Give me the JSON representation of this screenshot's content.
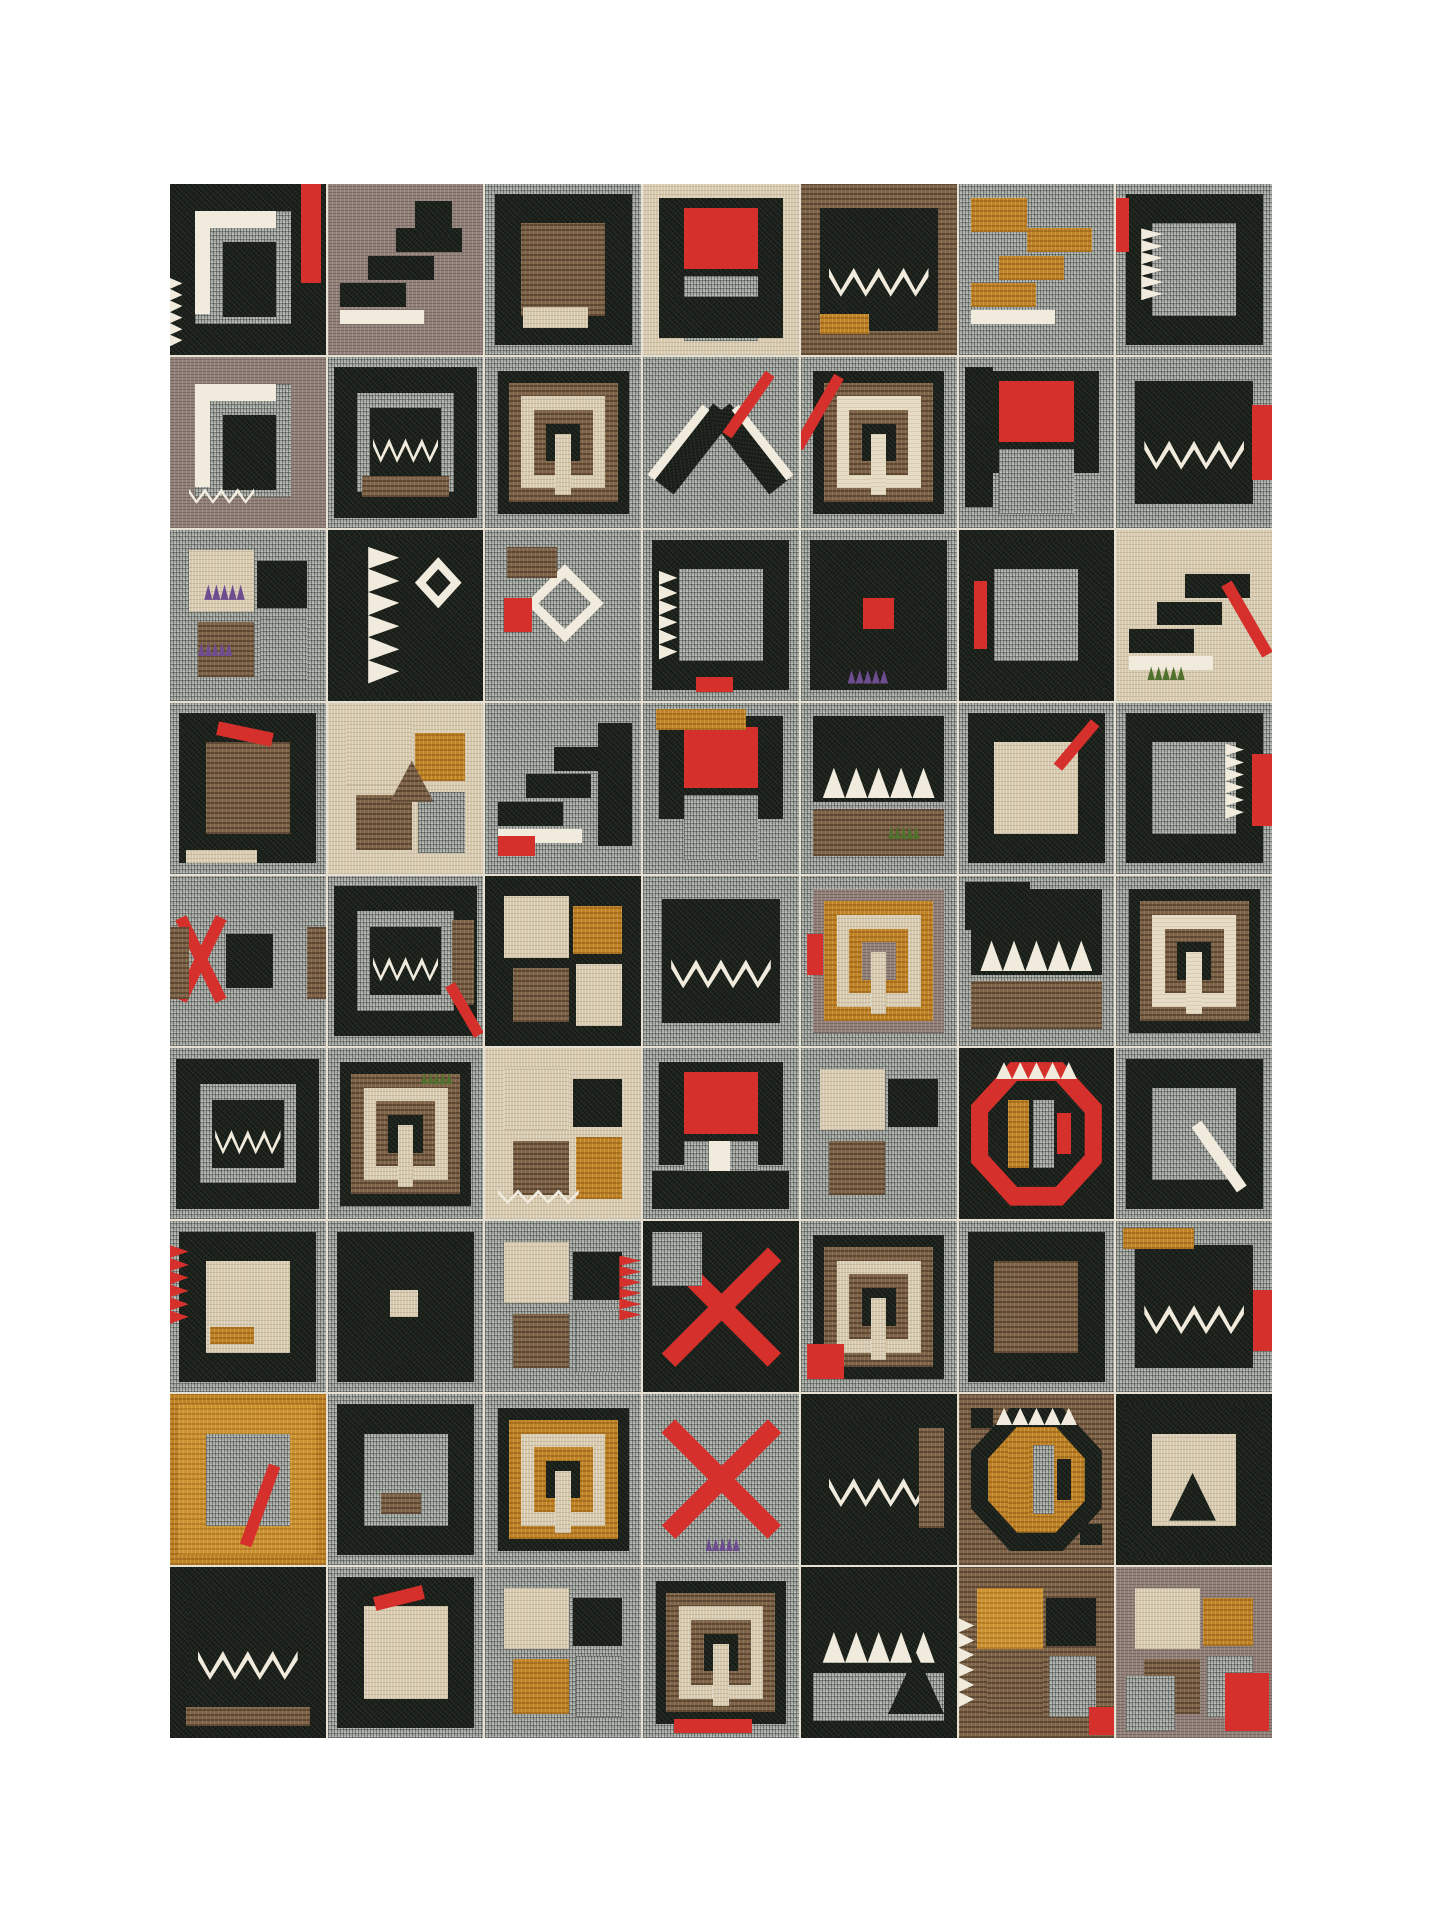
{
  "page": {
    "background": "#ffffff"
  },
  "artwork": {
    "kind": "fabric-collage-grid",
    "left": 170,
    "top": 184,
    "width": 1102,
    "height": 1554,
    "cols": 7,
    "rows": 9,
    "seam_color": "#e7e1d3"
  },
  "palette": {
    "gray": "#a4a8a2",
    "black": "#1d231c",
    "brown": "#7d6348",
    "tan": "#d6c9ae",
    "mauve": "#93827b",
    "ochre": "#bf8226",
    "cream": "#e7ddc6",
    "gold": "#cd9231",
    "red": "#d6302c",
    "white": "#f1ebdd",
    "purple": "#6d4d90",
    "green": "#50702e"
  },
  "textured": [
    "gray",
    "black",
    "brown",
    "tan",
    "mauve",
    "ochre",
    "cream",
    "gold"
  ],
  "motifs": {
    "bars": [
      [
        "r",
        "gray",
        16,
        16,
        62,
        66
      ],
      [
        "r",
        "white",
        16,
        16,
        10,
        60
      ],
      [
        "r",
        "white",
        16,
        16,
        52,
        10
      ],
      [
        "r",
        "black",
        34,
        34,
        34,
        44
      ]
    ],
    "frame": [
      [
        "r",
        "black",
        6,
        6,
        88,
        88
      ],
      [
        "r",
        "gray",
        23,
        23,
        54,
        54
      ]
    ],
    "crown": [
      [
        "r",
        "black",
        12,
        14,
        76,
        72
      ],
      [
        "zz",
        "white",
        18,
        40,
        64,
        26
      ]
    ],
    "crownframe": [
      [
        "r",
        "black",
        4,
        6,
        92,
        88
      ],
      [
        "r",
        "gray",
        19,
        21,
        62,
        58
      ],
      [
        "r",
        "black",
        27,
        30,
        46,
        40
      ],
      [
        "zz",
        "white",
        29,
        40,
        42,
        22
      ]
    ],
    "teeth": [
      [
        "r",
        "black",
        8,
        8,
        84,
        50
      ],
      [
        "tu",
        "white",
        14,
        38,
        72,
        18
      ],
      [
        "r",
        "brown",
        8,
        62,
        84,
        28
      ]
    ],
    "keys": [
      [
        "r",
        "black",
        8,
        8,
        84,
        84
      ],
      [
        "r",
        "brown",
        15,
        15,
        70,
        70
      ],
      [
        "r",
        "tan",
        23,
        23,
        54,
        54
      ],
      [
        "r",
        "brown",
        31,
        31,
        38,
        38
      ],
      [
        "r",
        "black",
        39,
        39,
        22,
        22
      ],
      [
        "r",
        "tan",
        45,
        45,
        10,
        36
      ]
    ],
    "redblock": [
      [
        "r",
        "black",
        10,
        8,
        80,
        60
      ],
      [
        "r",
        "red",
        26,
        14,
        48,
        36
      ],
      [
        "r",
        "gray",
        26,
        54,
        48,
        38
      ]
    ],
    "cross": [
      [
        "bar",
        "red",
        44,
        6,
        12,
        88,
        45
      ],
      [
        "bar",
        "red",
        44,
        6,
        12,
        88,
        -45
      ]
    ],
    "steps": [
      [
        "r",
        "black",
        8,
        58,
        42,
        14
      ],
      [
        "r",
        "black",
        26,
        42,
        42,
        14
      ],
      [
        "r",
        "black",
        44,
        26,
        42,
        14
      ],
      [
        "r",
        "white",
        8,
        74,
        54,
        8
      ]
    ],
    "blocks": [
      [
        "r",
        "tan",
        12,
        12,
        42,
        36
      ],
      [
        "r",
        "black",
        56,
        18,
        32,
        28
      ],
      [
        "r",
        "brown",
        18,
        54,
        36,
        32
      ],
      [
        "r",
        "gray",
        58,
        52,
        30,
        36
      ]
    ],
    "chevron": [
      [
        "bar",
        "black",
        24,
        26,
        16,
        56,
        38
      ],
      [
        "bar",
        "black",
        60,
        26,
        16,
        56,
        -38
      ],
      [
        "bar",
        "white",
        20,
        24,
        6,
        52,
        38
      ],
      [
        "bar",
        "white",
        74,
        24,
        6,
        52,
        -38
      ]
    ],
    "zigzagcol": [
      [
        "r",
        "black",
        8,
        4,
        84,
        92
      ],
      [
        "tl",
        "white",
        26,
        10,
        20,
        80
      ],
      [
        "dia",
        "white",
        56,
        16,
        30,
        30
      ],
      [
        "dia",
        "black",
        63,
        23,
        16,
        16
      ]
    ],
    "hexring": [
      [
        "oct",
        "red",
        8,
        8,
        84,
        84
      ],
      [
        "oct",
        "black",
        19,
        19,
        62,
        62
      ],
      [
        "r",
        "ochre",
        32,
        30,
        13,
        40
      ],
      [
        "r",
        "gray",
        48,
        30,
        13,
        40
      ],
      [
        "r",
        "red",
        63,
        38,
        9,
        24
      ],
      [
        "tu",
        "white",
        24,
        8,
        52,
        10
      ]
    ],
    "diamond": [
      [
        "dia",
        "white",
        26,
        20,
        50,
        46
      ],
      [
        "dia",
        "gray",
        34,
        28,
        34,
        30
      ],
      [
        "r",
        "red",
        12,
        40,
        18,
        20
      ]
    ],
    "brackets": [
      [
        "bar",
        "red",
        16,
        22,
        8,
        54,
        26
      ],
      [
        "bar",
        "red",
        16,
        22,
        8,
        54,
        -26
      ],
      [
        "r",
        "black",
        36,
        34,
        30,
        32
      ]
    ],
    "tri": [
      [
        "tri",
        "black",
        24,
        32,
        52,
        44
      ]
    ]
  },
  "tiles": [
    {
      "b": "black",
      "m": "bars",
      "add": [
        [
          "r",
          "red",
          84,
          0,
          13,
          58
        ],
        [
          "tl",
          "white",
          0,
          55,
          8,
          40
        ]
      ]
    },
    {
      "b": "mauve",
      "m": "steps",
      "add": [
        [
          "r",
          "black",
          56,
          10,
          24,
          20
        ]
      ]
    },
    {
      "b": "gray",
      "m": "frame",
      "sw": {
        "gray": "brown"
      },
      "add": [
        [
          "r",
          "tan",
          24,
          72,
          42,
          12
        ]
      ]
    },
    {
      "b": "tan",
      "m": "redblock",
      "add": [
        [
          "r",
          "black",
          10,
          66,
          80,
          24
        ]
      ]
    },
    {
      "b": "brown",
      "m": "crown",
      "add": [
        [
          "r",
          "ochre",
          12,
          76,
          32,
          12
        ]
      ]
    },
    {
      "b": "gray",
      "m": "steps",
      "sw": {
        "black": "ochre"
      },
      "add": [
        [
          "r",
          "black",
          8,
          8,
          36,
          20
        ]
      ]
    },
    {
      "b": "gray",
      "m": "frame",
      "add": [
        [
          "tl",
          "white",
          16,
          26,
          14,
          42
        ],
        [
          "r",
          "red",
          0,
          8,
          8,
          32
        ]
      ]
    },
    {
      "b": "mauve",
      "m": "bars",
      "add": [
        [
          "zz",
          "white",
          12,
          72,
          42,
          14
        ]
      ]
    },
    {
      "b": "gray",
      "m": "crownframe",
      "add": [
        [
          "r",
          "brown",
          22,
          70,
          56,
          12
        ]
      ]
    },
    {
      "b": "gray",
      "m": "keys"
    },
    {
      "b": "gray",
      "m": "chevron",
      "add": [
        [
          "bar",
          "red",
          64,
          6,
          7,
          44,
          35
        ]
      ]
    },
    {
      "b": "gray",
      "m": "keys",
      "sw": {
        "tan": "cream"
      },
      "add": [
        [
          "bar",
          "red",
          8,
          8,
          7,
          48,
          30
        ]
      ]
    },
    {
      "b": "gray",
      "m": "redblock",
      "add": [
        [
          "r",
          "black",
          4,
          6,
          18,
          82
        ]
      ]
    },
    {
      "b": "gray",
      "m": "crown",
      "add": [
        [
          "r",
          "red",
          87,
          28,
          13,
          44
        ]
      ]
    },
    {
      "b": "gray",
      "m": "blocks",
      "add": [
        [
          "tu",
          "purple",
          22,
          32,
          26,
          9
        ],
        [
          "tu",
          "purple",
          18,
          66,
          22,
          8
        ]
      ]
    },
    {
      "b": "black",
      "m": "zigzagcol"
    },
    {
      "b": "gray",
      "m": "diamond",
      "add": [
        [
          "r",
          "brown",
          14,
          10,
          32,
          18
        ]
      ]
    },
    {
      "b": "gray",
      "m": "frame",
      "add": [
        [
          "tl",
          "white",
          10,
          24,
          12,
          52
        ],
        [
          "r",
          "red",
          34,
          86,
          24,
          9
        ]
      ]
    },
    {
      "b": "gray",
      "m": "frame",
      "sw": {
        "gray": "black"
      },
      "add": [
        [
          "r",
          "red",
          40,
          40,
          20,
          18
        ],
        [
          "tu",
          "purple",
          30,
          82,
          26,
          8
        ]
      ]
    },
    {
      "b": "black",
      "m": "frame",
      "add": [
        [
          "r",
          "red",
          10,
          30,
          8,
          40
        ]
      ]
    },
    {
      "b": "tan",
      "m": "steps",
      "add": [
        [
          "bar",
          "red",
          80,
          28,
          8,
          48,
          -30
        ],
        [
          "tu",
          "green",
          20,
          80,
          24,
          8
        ]
      ]
    },
    {
      "b": "gray",
      "m": "frame",
      "sw": {
        "gray": "brown"
      },
      "add": [
        [
          "bar",
          "red",
          30,
          14,
          36,
          8,
          12
        ],
        [
          "r",
          "tan",
          10,
          86,
          46,
          8
        ]
      ]
    },
    {
      "b": "tan",
      "m": "blocks",
      "sw": {
        "black": "ochre"
      },
      "add": [
        [
          "tri",
          "brown",
          40,
          34,
          28,
          24
        ]
      ]
    },
    {
      "b": "gray",
      "m": "steps",
      "add": [
        [
          "r",
          "red",
          8,
          78,
          24,
          12
        ],
        [
          "r",
          "black",
          72,
          12,
          22,
          72
        ]
      ]
    },
    {
      "b": "gray",
      "m": "redblock",
      "add": [
        [
          "r",
          "ochre",
          8,
          4,
          58,
          12
        ]
      ]
    },
    {
      "b": "gray",
      "m": "teeth",
      "add": [
        [
          "tu",
          "green",
          56,
          72,
          20,
          8
        ]
      ]
    },
    {
      "b": "gray",
      "m": "frame",
      "sw": {
        "gray": "tan"
      },
      "add": [
        [
          "bar",
          "red",
          72,
          8,
          7,
          34,
          40
        ]
      ]
    },
    {
      "b": "gray",
      "m": "frame",
      "add": [
        [
          "r",
          "red",
          87,
          30,
          13,
          42
        ],
        [
          "tl",
          "white",
          70,
          24,
          12,
          44
        ]
      ]
    },
    {
      "b": "gray",
      "m": "brackets",
      "add": [
        [
          "r",
          "brown",
          0,
          30,
          12,
          42
        ],
        [
          "r",
          "brown",
          88,
          30,
          12,
          42
        ]
      ]
    },
    {
      "b": "gray",
      "m": "crownframe",
      "add": [
        [
          "r",
          "brown",
          80,
          26,
          14,
          50
        ],
        [
          "bar",
          "red",
          84,
          62,
          7,
          34,
          -30
        ]
      ]
    },
    {
      "b": "black",
      "m": "blocks",
      "sw": {
        "black": "ochre",
        "gray": "tan"
      }
    },
    {
      "b": "gray",
      "m": "crown"
    },
    {
      "b": "gray",
      "m": "keys",
      "sw": {
        "brown": "ochre",
        "black": "mauve"
      },
      "add": [
        [
          "r",
          "red",
          4,
          34,
          10,
          24
        ]
      ]
    },
    {
      "b": "gray",
      "m": "teeth",
      "add": [
        [
          "r",
          "black",
          4,
          4,
          42,
          28
        ]
      ]
    },
    {
      "b": "gray",
      "m": "keys",
      "sw": {
        "tan": "cream"
      }
    },
    {
      "b": "gray",
      "m": "crownframe"
    },
    {
      "b": "gray",
      "m": "keys",
      "add": [
        [
          "tu",
          "green",
          60,
          14,
          20,
          7
        ]
      ]
    },
    {
      "b": "tan",
      "m": "blocks",
      "sw": {
        "gray": "ochre"
      },
      "add": [
        [
          "zz",
          "white",
          8,
          78,
          52,
          13
        ]
      ]
    },
    {
      "b": "gray",
      "m": "redblock",
      "add": [
        [
          "r",
          "white",
          42,
          54,
          14,
          32
        ],
        [
          "r",
          "black",
          6,
          72,
          88,
          22
        ]
      ]
    },
    {
      "b": "gray",
      "m": "blocks"
    },
    {
      "b": "black",
      "m": "hexring"
    },
    {
      "b": "gray",
      "m": "frame",
      "add": [
        [
          "bar",
          "white",
          62,
          40,
          8,
          46,
          -35
        ]
      ]
    },
    {
      "b": "gray",
      "m": "frame",
      "sw": {
        "gray": "tan"
      },
      "add": [
        [
          "tl",
          "red",
          0,
          14,
          12,
          46
        ],
        [
          "r",
          "ochre",
          26,
          62,
          28,
          10
        ]
      ]
    },
    {
      "b": "gray",
      "m": "frame",
      "sw": {
        "gray": "black"
      },
      "add": [
        [
          "r",
          "tan",
          40,
          40,
          18,
          16
        ]
      ]
    },
    {
      "b": "gray",
      "m": "blocks",
      "add": [
        [
          "tl",
          "red",
          86,
          20,
          14,
          38
        ]
      ]
    },
    {
      "b": "black",
      "m": "cross",
      "add": [
        [
          "r",
          "gray",
          6,
          6,
          32,
          32
        ]
      ]
    },
    {
      "b": "gray",
      "m": "keys",
      "add": [
        [
          "r",
          "red",
          4,
          72,
          24,
          20
        ]
      ]
    },
    {
      "b": "gray",
      "m": "frame",
      "sw": {
        "gray": "brown"
      }
    },
    {
      "b": "gray",
      "m": "crown",
      "add": [
        [
          "r",
          "ochre",
          4,
          4,
          46,
          12
        ],
        [
          "r",
          "red",
          88,
          40,
          12,
          36
        ]
      ]
    },
    {
      "b": "ochre",
      "m": "frame",
      "sw": {
        "black": "gold"
      },
      "add": [
        [
          "bar",
          "red",
          54,
          40,
          8,
          50,
          20
        ]
      ]
    },
    {
      "b": "gray",
      "m": "frame",
      "add": [
        [
          "r",
          "brown",
          34,
          58,
          26,
          12
        ]
      ]
    },
    {
      "b": "gray",
      "m": "keys",
      "sw": {
        "brown": "ochre"
      }
    },
    {
      "b": "gray",
      "m": "cross",
      "add": [
        [
          "tu",
          "purple",
          40,
          84,
          22,
          8
        ]
      ]
    },
    {
      "b": "black",
      "m": "crown",
      "add": [
        [
          "r",
          "brown",
          76,
          20,
          16,
          58
        ]
      ]
    },
    {
      "b": "brown",
      "m": "hexring",
      "sw": {
        "red": "black",
        "black": "ochre"
      },
      "add": [
        [
          "r",
          "red",
          8,
          8,
          14,
          12
        ],
        [
          "r",
          "red",
          78,
          76,
          14,
          12
        ]
      ]
    },
    {
      "b": "black",
      "m": "frame",
      "sw": {
        "gray": "tan"
      },
      "add": [
        [
          "tri",
          "black",
          34,
          46,
          30,
          28
        ]
      ]
    },
    {
      "b": "black",
      "m": "crown",
      "add": [
        [
          "r",
          "brown",
          10,
          82,
          80,
          11
        ]
      ]
    },
    {
      "b": "gray",
      "m": "frame",
      "sw": {
        "gray": "tan"
      },
      "add": [
        [
          "bar",
          "red",
          30,
          14,
          32,
          8,
          -14
        ]
      ]
    },
    {
      "b": "gray",
      "m": "blocks",
      "sw": {
        "brown": "ochre"
      }
    },
    {
      "b": "gray",
      "m": "keys",
      "add": [
        [
          "r",
          "red",
          20,
          89,
          50,
          8
        ]
      ]
    },
    {
      "b": "black",
      "m": "teeth",
      "sw": {
        "brown": "gray"
      },
      "add": [
        [
          "tri",
          "black",
          56,
          50,
          36,
          36
        ]
      ]
    },
    {
      "b": "brown",
      "m": "blocks",
      "sw": {
        "tan": "gold"
      },
      "add": [
        [
          "tl",
          "white",
          0,
          30,
          10,
          52
        ],
        [
          "r",
          "red",
          84,
          82,
          16,
          16
        ]
      ]
    },
    {
      "b": "mauve",
      "m": "blocks",
      "sw": {
        "black": "ochre"
      },
      "add": [
        [
          "r",
          "red",
          70,
          62,
          28,
          34
        ],
        [
          "r",
          "gray",
          6,
          64,
          32,
          32
        ]
      ]
    }
  ]
}
